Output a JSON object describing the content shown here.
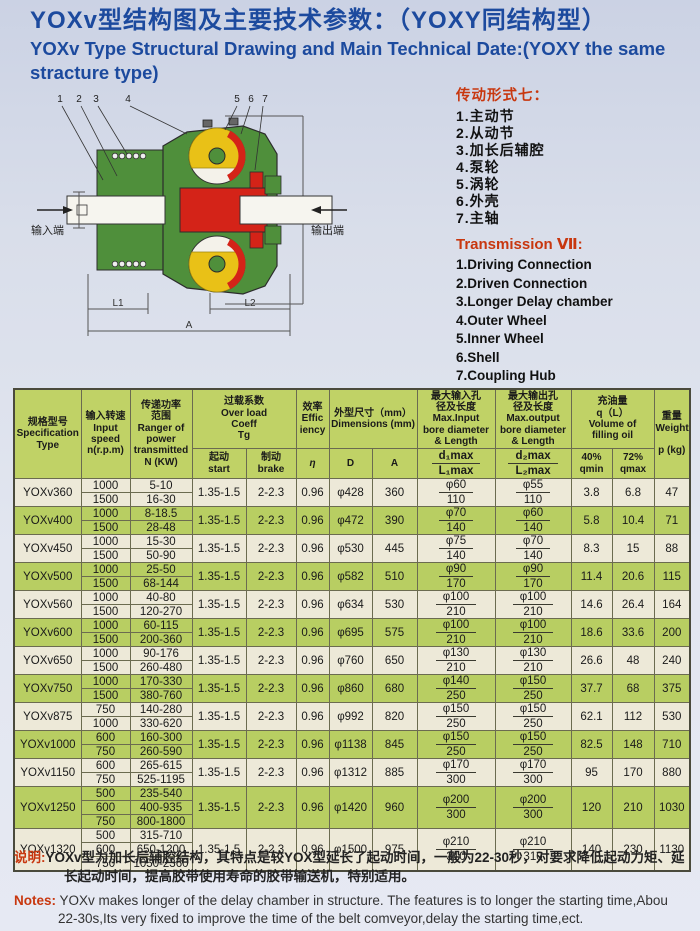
{
  "page": {
    "title_zh": "YOXv型结构图及主要技术参数：（YOXY同结构型）",
    "title_en": "YOXv Type Structural Drawing and Main Technical Date:(YOXY the same stracture type)"
  },
  "diagram": {
    "callouts": [
      "1",
      "2",
      "3",
      "4",
      "5",
      "6",
      "7"
    ],
    "input_label": "输入端",
    "output_label": "输出端",
    "dim_l1": "L1",
    "dim_l2": "L2",
    "dim_a": "A",
    "dim_d": "D",
    "colors": {
      "green": "#4f8f3b",
      "red": "#d42318",
      "yellow": "#e9c117",
      "line": "#333333"
    }
  },
  "legend": {
    "title_zh": "传动形式七：",
    "items_zh": [
      "1.主动节",
      "2.从动节",
      "3.加长后辅腔",
      "4.泵轮",
      "5.涡轮",
      "6.外壳",
      "7.主轴"
    ],
    "title_en": "Transmission Ⅶ:",
    "items_en": [
      "1.Driving Connection",
      "2.Driven Connection",
      "3.Longer Delay chamber",
      "4.Outer Wheel",
      "5.Inner Wheel",
      "6.Shell",
      "7.Coupling Hub"
    ]
  },
  "table": {
    "headers": {
      "spec": "规格型号\nSpecification\nType",
      "speed": "输入转速\nInput\nspeed\nn(r.p.m)",
      "power": "传递功率\n范围\nRanger of\npower\ntransmitted\nN (KW)",
      "overload": "过载系数\nOver load\nCoeff\nTg",
      "start": "起动\nstart",
      "brake": "制动\nbrake",
      "eff": "效率\nEffic\niency",
      "eta": "η",
      "dims": "外型尺寸（mm）\nDimensions (mm)",
      "d": "D",
      "a": "A",
      "din": "最大输入孔\n径及长度\nMax.Input\nbore diameter\n& Length",
      "din_top": "d₁max",
      "din_bot": "L₁max",
      "dout": "最大输出孔\n径及长度\nMax.output\nbore diameter\n& Length",
      "dout_top": "d₂max",
      "dout_bot": "L₂max",
      "oil": "充油量\nq（L）\nVolume of\nfilling oil",
      "qmin": "40%\nqmin",
      "qmax": "72%\nqmax",
      "weight": "重量\nWeight\n\np (kg)"
    },
    "rows": [
      {
        "type": "YOXv360",
        "speeds": [
          {
            "n": "1000",
            "power": "5-10"
          },
          {
            "n": "1500",
            "power": "16-30"
          }
        ],
        "start": "1.35-1.5",
        "brake": "2-2.3",
        "eff": "0.96",
        "D": "φ428",
        "A": "360",
        "din": {
          "d": "φ60",
          "L": "110"
        },
        "dout": {
          "d": "φ55",
          "L": "110"
        },
        "qmin": "3.8",
        "qmax": "6.8",
        "weight": "47"
      },
      {
        "type": "YOXv400",
        "speeds": [
          {
            "n": "1000",
            "power": "8-18.5"
          },
          {
            "n": "1500",
            "power": "28-48"
          }
        ],
        "start": "1.35-1.5",
        "brake": "2-2.3",
        "eff": "0.96",
        "D": "φ472",
        "A": "390",
        "din": {
          "d": "φ70",
          "L": "140"
        },
        "dout": {
          "d": "φ60",
          "L": "140"
        },
        "qmin": "5.8",
        "qmax": "10.4",
        "weight": "71"
      },
      {
        "type": "YOXv450",
        "speeds": [
          {
            "n": "1000",
            "power": "15-30"
          },
          {
            "n": "1500",
            "power": "50-90"
          }
        ],
        "start": "1.35-1.5",
        "brake": "2-2.3",
        "eff": "0.96",
        "D": "φ530",
        "A": "445",
        "din": {
          "d": "φ75",
          "L": "140"
        },
        "dout": {
          "d": "φ70",
          "L": "140"
        },
        "qmin": "8.3",
        "qmax": "15",
        "weight": "88"
      },
      {
        "type": "YOXv500",
        "speeds": [
          {
            "n": "1000",
            "power": "25-50"
          },
          {
            "n": "1500",
            "power": "68-144"
          }
        ],
        "start": "1.35-1.5",
        "brake": "2-2.3",
        "eff": "0.96",
        "D": "φ582",
        "A": "510",
        "din": {
          "d": "φ90",
          "L": "170"
        },
        "dout": {
          "d": "φ90",
          "L": "170"
        },
        "qmin": "11.4",
        "qmax": "20.6",
        "weight": "115"
      },
      {
        "type": "YOXv560",
        "speeds": [
          {
            "n": "1000",
            "power": "40-80"
          },
          {
            "n": "1500",
            "power": "120-270"
          }
        ],
        "start": "1.35-1.5",
        "brake": "2-2.3",
        "eff": "0.96",
        "D": "φ634",
        "A": "530",
        "din": {
          "d": "φ100",
          "L": "210"
        },
        "dout": {
          "d": "φ100",
          "L": "210"
        },
        "qmin": "14.6",
        "qmax": "26.4",
        "weight": "164"
      },
      {
        "type": "YOXv600",
        "speeds": [
          {
            "n": "1000",
            "power": "60-115"
          },
          {
            "n": "1500",
            "power": "200-360"
          }
        ],
        "start": "1.35-1.5",
        "brake": "2-2.3",
        "eff": "0.96",
        "D": "φ695",
        "A": "575",
        "din": {
          "d": "φ100",
          "L": "210"
        },
        "dout": {
          "d": "φ100",
          "L": "210"
        },
        "qmin": "18.6",
        "qmax": "33.6",
        "weight": "200"
      },
      {
        "type": "YOXv650",
        "speeds": [
          {
            "n": "1000",
            "power": "90-176"
          },
          {
            "n": "1500",
            "power": "260-480"
          }
        ],
        "start": "1.35-1.5",
        "brake": "2-2.3",
        "eff": "0.96",
        "D": "φ760",
        "A": "650",
        "din": {
          "d": "φ130",
          "L": "210"
        },
        "dout": {
          "d": "φ130",
          "L": "210"
        },
        "qmin": "26.6",
        "qmax": "48",
        "weight": "240"
      },
      {
        "type": "YOXv750",
        "speeds": [
          {
            "n": "1000",
            "power": "170-330"
          },
          {
            "n": "1500",
            "power": "380-760"
          }
        ],
        "start": "1.35-1.5",
        "brake": "2-2.3",
        "eff": "0.96",
        "D": "φ860",
        "A": "680",
        "din": {
          "d": "φ140",
          "L": "250"
        },
        "dout": {
          "d": "φ150",
          "L": "250"
        },
        "qmin": "37.7",
        "qmax": "68",
        "weight": "375"
      },
      {
        "type": "YOXv875",
        "speeds": [
          {
            "n": "750",
            "power": "140-280"
          },
          {
            "n": "1000",
            "power": "330-620"
          }
        ],
        "start": "1.35-1.5",
        "brake": "2-2.3",
        "eff": "0.96",
        "D": "φ992",
        "A": "820",
        "din": {
          "d": "φ150",
          "L": "250"
        },
        "dout": {
          "d": "φ150",
          "L": "250"
        },
        "qmin": "62.1",
        "qmax": "112",
        "weight": "530"
      },
      {
        "type": "YOXv1000",
        "speeds": [
          {
            "n": "600",
            "power": "160-300"
          },
          {
            "n": "750",
            "power": "260-590"
          }
        ],
        "start": "1.35-1.5",
        "brake": "2-2.3",
        "eff": "0.96",
        "D": "φ1138",
        "A": "845",
        "din": {
          "d": "φ150",
          "L": "250"
        },
        "dout": {
          "d": "φ150",
          "L": "250"
        },
        "qmin": "82.5",
        "qmax": "148",
        "weight": "710"
      },
      {
        "type": "YOXv1150",
        "speeds": [
          {
            "n": "600",
            "power": "265-615"
          },
          {
            "n": "750",
            "power": "525-1195"
          }
        ],
        "start": "1.35-1.5",
        "brake": "2-2.3",
        "eff": "0.96",
        "D": "φ1312",
        "A": "885",
        "din": {
          "d": "φ170",
          "L": "300"
        },
        "dout": {
          "d": "φ170",
          "L": "300"
        },
        "qmin": "95",
        "qmax": "170",
        "weight": "880"
      },
      {
        "type": "YOXv1250",
        "speeds": [
          {
            "n": "500",
            "power": "235-540"
          },
          {
            "n": "600",
            "power": "400-935"
          },
          {
            "n": "750",
            "power": "800-1800"
          }
        ],
        "start": "1.35-1.5",
        "brake": "2-2.3",
        "eff": "0.96",
        "D": "φ1420",
        "A": "960",
        "din": {
          "d": "φ200",
          "L": "300"
        },
        "dout": {
          "d": "φ200",
          "L": "300"
        },
        "qmin": "120",
        "qmax": "210",
        "weight": "1030"
      },
      {
        "type": "YOXv1320",
        "speeds": [
          {
            "n": "500",
            "power": "315-710"
          },
          {
            "n": "600",
            "power": "650-1200"
          },
          {
            "n": "750",
            "power": "1050-2360"
          }
        ],
        "start": "1.35-1.5",
        "brake": "2-2.3",
        "eff": "0.96",
        "D": "φ1500",
        "A": "975",
        "din": {
          "d": "φ210",
          "L": "310"
        },
        "dout": {
          "d": "φ210",
          "L": "310"
        },
        "qmin": "140",
        "qmax": "230",
        "weight": "1130"
      }
    ]
  },
  "notes": {
    "zh_label": "说明:",
    "zh_text": "YOXv型为加长后辅腔结构，其特点是较YOX型延长了起动时间，一般为22-30秒，对要求降低起动力矩、延长起动时间，提高胶带使用寿命的胶带输送机，特别适用。",
    "en_label": "Notes:",
    "en_text": "YOXv makes longer of the delay chamber in structure. The features is to longer the starting time,Abou 22-30s,Its very fixed to improve the time of the belt comveyor,delay the starting time,ect."
  }
}
